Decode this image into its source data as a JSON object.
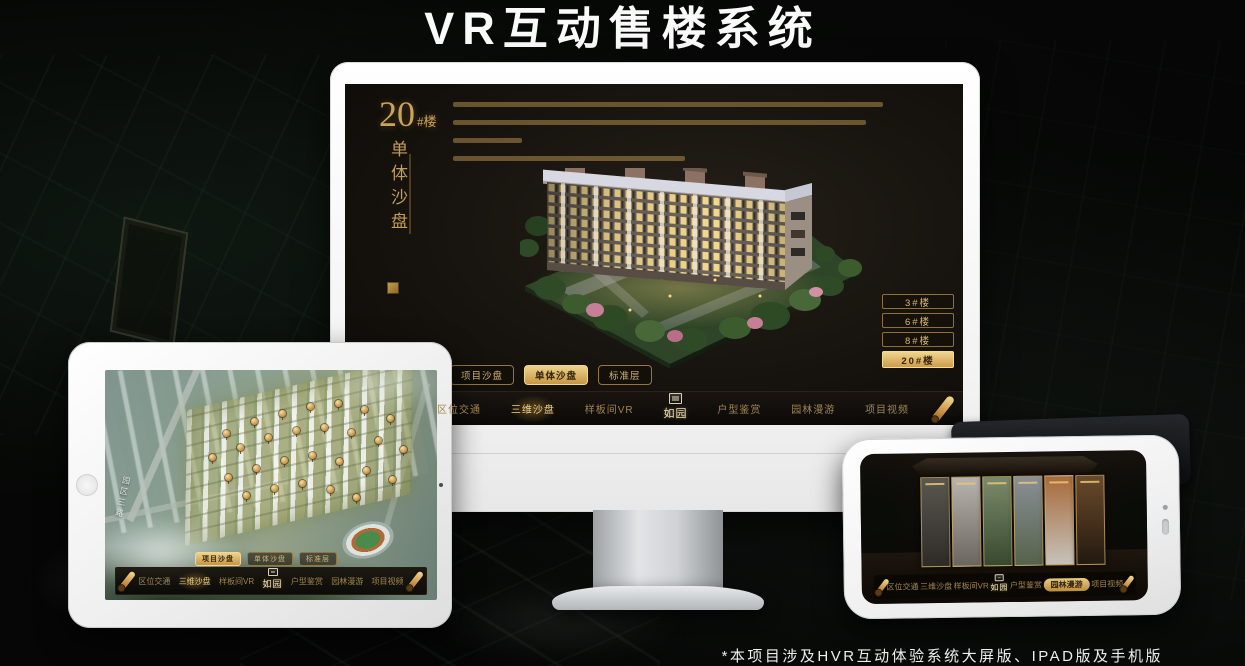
{
  "header": {
    "title": "VR互动售楼系统"
  },
  "footer": {
    "note": "*本项目涉及HVR互动体验系统大屏版、IPAD版及手机版"
  },
  "brand": {
    "logo_text": "如园"
  },
  "nav": {
    "items": [
      "区位交通",
      "三维沙盘",
      "样板间VR",
      "户型鉴赏",
      "园林漫游",
      "项目视频"
    ]
  },
  "tabs": {
    "items": [
      "项目沙盘",
      "单体沙盘",
      "标准层"
    ]
  },
  "monitor_screen": {
    "title_number": "20",
    "title_unit": "#楼",
    "subtitle_vertical": "单体沙盘",
    "building_buttons": [
      "3#楼",
      "6#楼",
      "8#楼",
      "20#楼"
    ],
    "active_building": "20#楼",
    "active_tab": "单体沙盘",
    "active_nav": "三维沙盘"
  },
  "ipad_screen": {
    "road_label": "园区三路",
    "active_tab": "项目沙盘",
    "active_nav": "三维沙盘"
  },
  "phone_screen": {
    "active_nav": "园林漫游"
  },
  "colors": {
    "gold": "#c9a45c",
    "active_fill": "#d9b163",
    "screen_bg": "#17130e"
  }
}
